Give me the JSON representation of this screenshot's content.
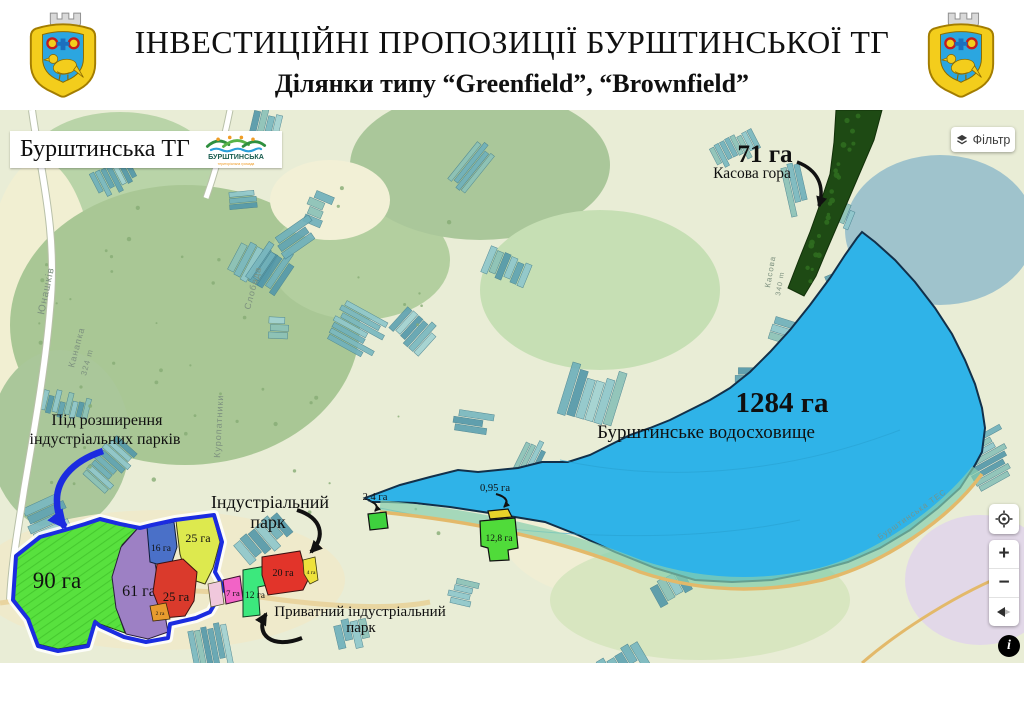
{
  "header": {
    "title": "ІНВЕСТИЦІЙНІ ПРОПОЗИЦІЇ БУРШТИНСЬКОЇ ТГ",
    "subtitle": "Ділянки типу “Greenfield”, “Brownfield”"
  },
  "map": {
    "community_label": "Бурштинська ТГ",
    "logo": {
      "line1": "БУРШТИНСЬКА",
      "line2": "територіальна громада"
    },
    "filter_label": "Фільтр",
    "kasova": {
      "area": "71 га",
      "name": "Касова гора",
      "color": "#1e4a14"
    },
    "reservoir": {
      "area": "1284 га",
      "name": "Бурштинське водосховище",
      "color": "#2fb3e8"
    },
    "annotations": {
      "expansion_line1": "Під розширення",
      "expansion_line2": "індустріальних парків",
      "industrial_line1": "Індустріальний",
      "industrial_line2": "парк",
      "private_line1": "Приватний індустріальний",
      "private_line2": "парк"
    },
    "cluster_border_color": "#1b2ce0",
    "parcels": [
      {
        "id": "90ha",
        "label": "90 га",
        "color": "#58e13e"
      },
      {
        "id": "61ha",
        "label": "61 га",
        "color": "#9d80c4"
      },
      {
        "id": "16ha",
        "label": "16 га",
        "color": "#4a70c8"
      },
      {
        "id": "25ha-yellow",
        "label": "25 га",
        "color": "#dde94e"
      },
      {
        "id": "25ha-red",
        "label": "25 га",
        "color": "#da3a2c"
      },
      {
        "id": "2ha",
        "label": "2 га",
        "color": "#e89b2e"
      },
      {
        "id": "7ha",
        "label": "7 га",
        "color": "#f263c6"
      },
      {
        "id": "12ha",
        "label": "12 га",
        "color": "#3ce87d"
      },
      {
        "id": "20ha",
        "label": "20 га",
        "color": "#e2342a"
      },
      {
        "id": "4ha",
        "label": "4 га",
        "color": "#eee23c"
      },
      {
        "id": "2.4ha",
        "label": "2,4 га",
        "color": "#3ed13e"
      },
      {
        "id": "0.95ha",
        "label": "0,95 га",
        "color": "#e8d22a"
      },
      {
        "id": "12.8ha",
        "label": "12,8 га",
        "color": "#50db3a"
      }
    ],
    "place_labels": [
      "Юнашків",
      "Канапка",
      "324 m",
      "Куропатники",
      "Слобода",
      "Касова",
      "340 m",
      "Бурштинська ТЕС"
    ],
    "controls": {
      "zoom_in": "+",
      "zoom_out": "−",
      "info": "i"
    }
  }
}
